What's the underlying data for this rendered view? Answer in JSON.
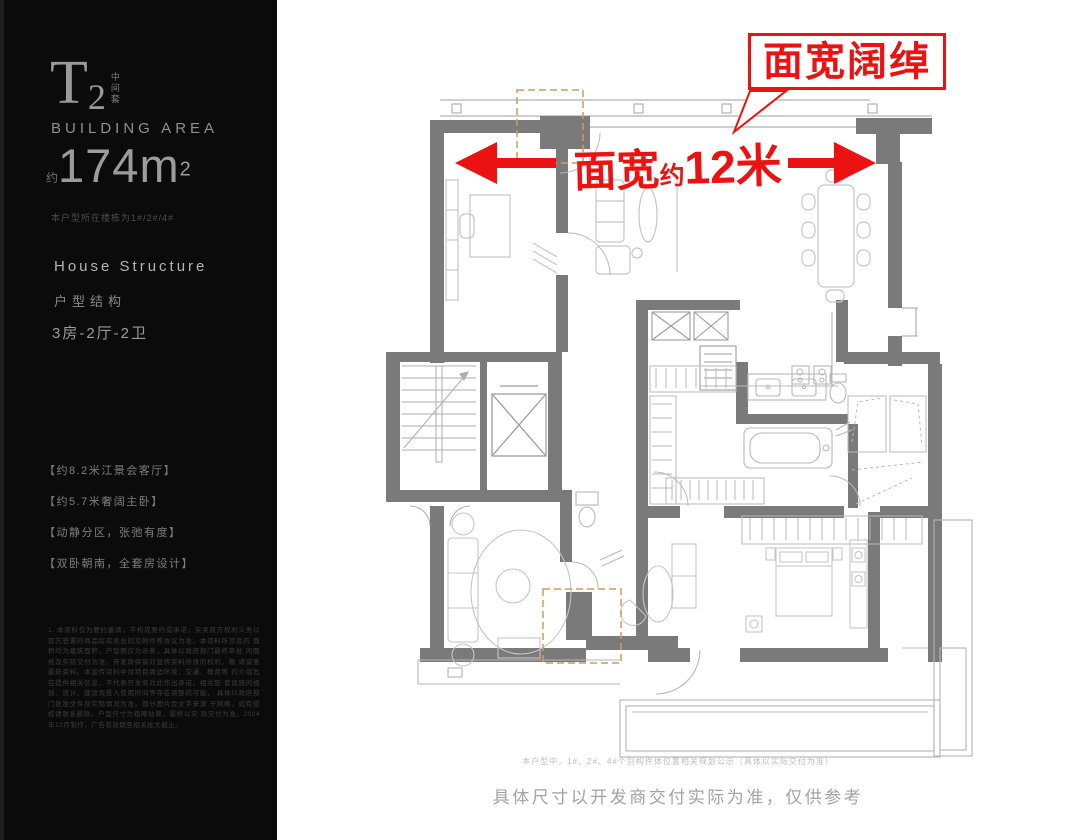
{
  "panel": {
    "unit_code_letter": "T",
    "unit_code_number": "2",
    "unit_code_side": "中间套",
    "building_area_label": "BUILDING AREA",
    "area_prefix": "约",
    "area_value": "174",
    "area_unit": "m",
    "area_sup": "2",
    "building_note": "本户型所在楼栋为1#/2#/4#",
    "structure_en": "House Structure",
    "structure_cn": "户型结构",
    "rooms": "3房-2厅-2卫",
    "bullets": [
      "【约8.2米江景会客厅】",
      "【约5.7米奢阔主卧】",
      "【动静分区，张弛有度】",
      "【双卧朝南，全套房设计】"
    ],
    "legal_lines": [
      "1. 本资料仅为要约邀请，不构成要约或承诺，买卖双方权利义务以",
      "双方签署的商品房买卖合同及附件等协议为准。本资料所涉及的",
      "面积均为建筑面积，户型图仅为示意，具体以政府部门最终审批",
      "的图纸及实际交付为准。开发商保留对宣传资料修改的权利，敬",
      "请留意最新资料。本宣传资料中对项目周边环境、交通、教育等",
      "的介绍旨在提供相关信息，不代表开发商对此作出承诺。相关配",
      "套设施的规划、设计、建设及投入使用时间等存在调整的可能，",
      "具体以政府部门批准文件及实际情况为准。部分图片及文字来源",
      "于网络，如有侵权请联系删除。户型尺寸为粗略估算，最终以实",
      "际交付为准。2024年12月制作，广告有效期至相关批文截止。"
    ]
  },
  "annotations": {
    "headline": "面宽阔绰",
    "dim_prefix": "面宽",
    "dim_approx": "约",
    "dim_value": "12米",
    "accent_color": "#ec1212",
    "highlight_dash_color": "#cf9a5f"
  },
  "captions": {
    "small": "本户型中，1#、2#、4#个别构件体位置相关规划公示（具体以实际交付为准）",
    "big": "具体尺寸以开发商交付实际为准，仅供参考"
  },
  "floorplan": {
    "wall_color": "#7a7a7a",
    "furniture_color": "#c6c6c6",
    "icons": [
      "stairs-icon",
      "elevator-icon",
      "shaft-icon",
      "desk-icon",
      "sofa-icon",
      "dining-table-icon",
      "stove-icon",
      "sink-icon",
      "toilet-icon",
      "bathtub-icon",
      "wardrobe-icon",
      "bed-icon",
      "balcony-railing"
    ]
  }
}
